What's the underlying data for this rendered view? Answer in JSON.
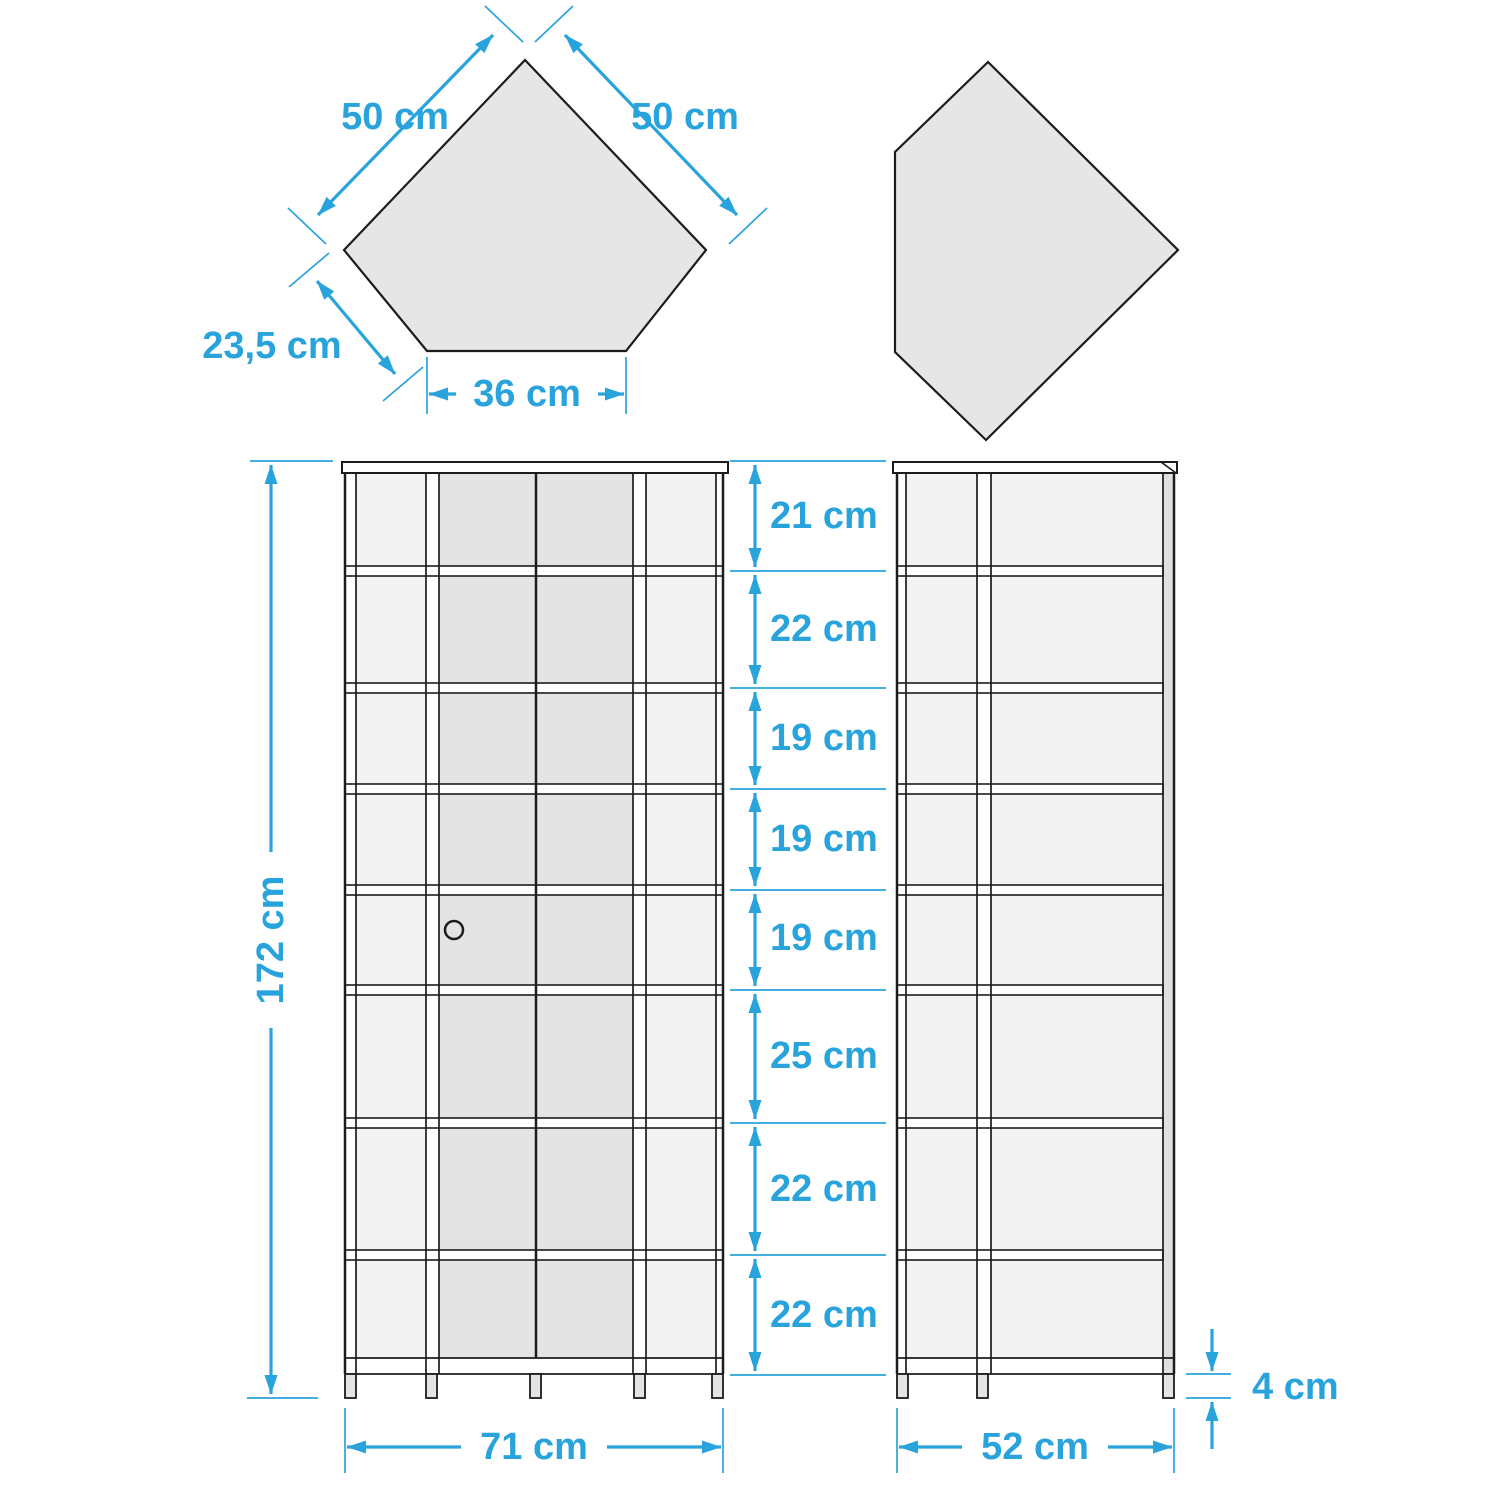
{
  "colors": {
    "accent": "#29A3DC",
    "outline": "#1C1C1C",
    "shape_fill": "#E6E6E6",
    "cell_fill": "#F3F3F3",
    "panel_fill": "#E4E4E4",
    "stile_gray": "#E0E0E0",
    "foot_fill": "#E4E4E4",
    "background": "#FFFFFF"
  },
  "top_view": {
    "left_shape": {
      "edge_left_label": "50 cm",
      "edge_right_label": "50 cm",
      "edge_lower_left_label": "23,5 cm",
      "bottom_edge_label": "36 cm"
    }
  },
  "front_view": {
    "height_label": "172 cm",
    "width_label": "71 cm",
    "shelf_labels": [
      "21 cm",
      "22 cm",
      "19 cm",
      "19 cm",
      "19 cm",
      "25 cm",
      "22 cm",
      "22 cm"
    ]
  },
  "side_view": {
    "width_label": "52 cm",
    "feet_height_label": "4 cm"
  }
}
